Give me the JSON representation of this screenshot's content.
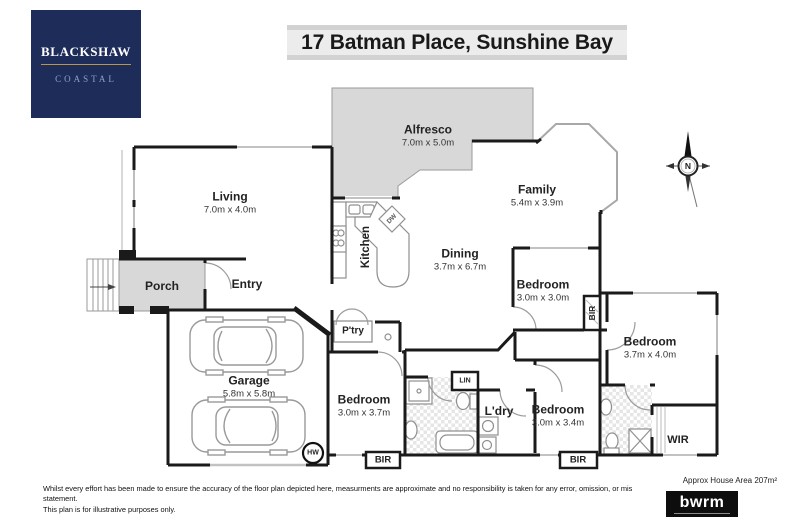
{
  "header": {
    "title": "17 Batman Place, Sunshine Bay"
  },
  "logo": {
    "brand": "BLACKSHAW",
    "division": "COASTAL"
  },
  "compass": {
    "label": "N"
  },
  "rooms": {
    "alfresco": {
      "name": "Alfresco",
      "dims": "7.0m x 5.0m"
    },
    "living": {
      "name": "Living",
      "dims": "7.0m x 4.0m"
    },
    "family": {
      "name": "Family",
      "dims": "5.4m x 3.9m"
    },
    "dining": {
      "name": "Dining",
      "dims": "3.7m x 6.7m"
    },
    "kitchen": {
      "name": "Kitchen"
    },
    "porch": {
      "name": "Porch"
    },
    "entry": {
      "name": "Entry"
    },
    "garage": {
      "name": "Garage",
      "dims": "5.8m x 5.8m"
    },
    "pantry": {
      "name": "P'try"
    },
    "bedroom1": {
      "name": "Bedroom",
      "dims": "3.0m x 3.7m"
    },
    "bedroom2": {
      "name": "Bedroom",
      "dims": "3.0m x 3.0m"
    },
    "bedroom3": {
      "name": "Bedroom",
      "dims": "3.7m x 4.0m"
    },
    "bedroom4": {
      "name": "Bedroom",
      "dims": "3.0m x 3.4m"
    },
    "laundry": {
      "name": "L'dry"
    },
    "linen": {
      "name": "LIN"
    },
    "wir": {
      "name": "WIR"
    },
    "bir": {
      "name": "BIR"
    },
    "dishwasher": {
      "name": "DW"
    },
    "hot_water": {
      "name": "HW"
    }
  },
  "footer": {
    "disclaimer_line1": "Whilst every effort has been made to ensure the accuracy of the floor plan depicted here, measurments are approximate and no responsibility is taken for any error, omission, or mis statement.",
    "disclaimer_line2": "This plan is for illustrative purposes only.",
    "area": "Approx House Area 207m²",
    "marketing_logo": "bwrm"
  },
  "colors": {
    "brand_navy": "#1e2c5a",
    "brand_gold": "#b5964a",
    "plan_gray": "#d8d8d8",
    "wall": "#1a1a1a"
  }
}
